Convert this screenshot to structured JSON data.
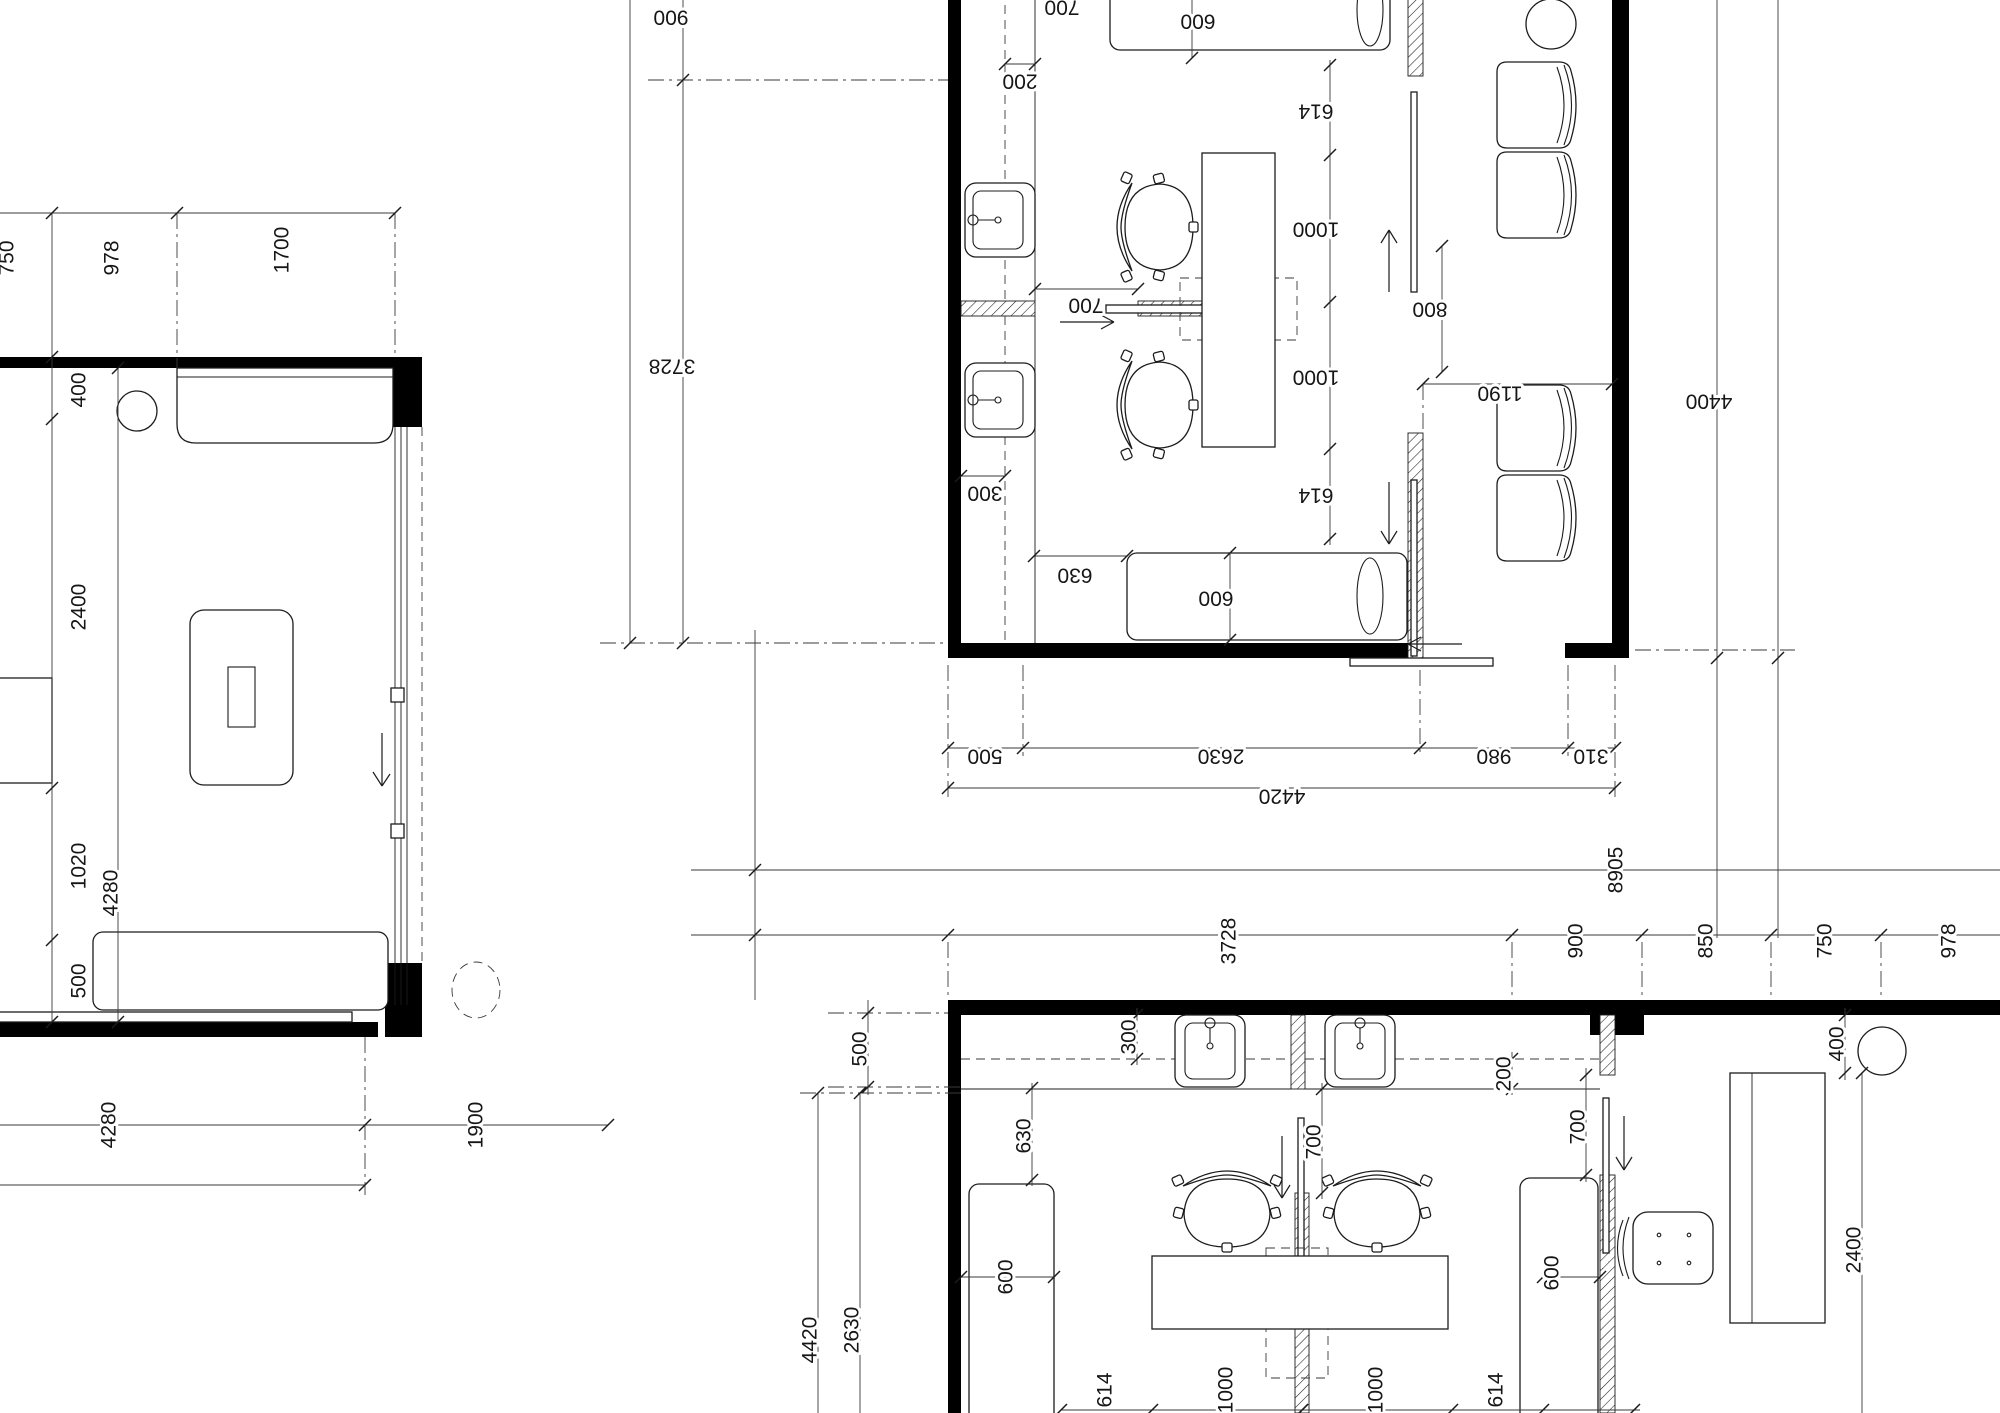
{
  "drawing": {
    "kind": "architectural floor plan, three plan views",
    "background": "#ffffff",
    "line_color": "#1c1c1c",
    "wall_color": "#000000"
  },
  "plans": {
    "a": {
      "name": "left room plan",
      "labels": [
        {
          "t": "750",
          "x": 8,
          "y": 258,
          "r": -90
        },
        {
          "t": "978",
          "x": 113,
          "y": 258,
          "r": -90
        },
        {
          "t": "1700",
          "x": 283,
          "y": 250,
          "r": -90
        },
        {
          "t": "400",
          "x": 80,
          "y": 390,
          "r": -90
        },
        {
          "t": "2400",
          "x": 80,
          "y": 607,
          "r": -90
        },
        {
          "t": "1020",
          "x": 80,
          "y": 866,
          "r": -90
        },
        {
          "t": "500",
          "x": 80,
          "y": 981,
          "r": -90
        },
        {
          "t": "4280",
          "x": 112,
          "y": 893,
          "r": -90
        },
        {
          "t": "4280",
          "x": 110,
          "y": 1125,
          "r": -90
        },
        {
          "t": "1900",
          "x": 477,
          "y": 1125,
          "r": -90
        }
      ]
    },
    "b": {
      "name": "upper right salon unit (rotated 180)",
      "labels": [
        {
          "t": "700",
          "x": 1062,
          "y": 6,
          "r": 180
        },
        {
          "t": "600",
          "x": 1198,
          "y": 20,
          "r": 180
        },
        {
          "t": "200",
          "x": 1020,
          "y": 80,
          "r": 180
        },
        {
          "t": "900",
          "x": 671,
          "y": 16,
          "r": 180
        },
        {
          "t": "3728",
          "x": 672,
          "y": 365,
          "r": 180
        },
        {
          "t": "614",
          "x": 1316,
          "y": 110,
          "r": 180
        },
        {
          "t": "1000",
          "x": 1316,
          "y": 228,
          "r": 180
        },
        {
          "t": "1000",
          "x": 1316,
          "y": 376,
          "r": 180
        },
        {
          "t": "614",
          "x": 1316,
          "y": 494,
          "r": 180
        },
        {
          "t": "700",
          "x": 1086,
          "y": 304,
          "r": 180
        },
        {
          "t": "300",
          "x": 985,
          "y": 492,
          "r": 180
        },
        {
          "t": "630",
          "x": 1075,
          "y": 574,
          "r": 180
        },
        {
          "t": "600",
          "x": 1216,
          "y": 597,
          "r": 180
        },
        {
          "t": "800",
          "x": 1430,
          "y": 308,
          "r": 180
        },
        {
          "t": "1190",
          "x": 1500,
          "y": 392,
          "r": 180
        },
        {
          "t": "4400",
          "x": 1709,
          "y": 400,
          "r": 180
        },
        {
          "t": "500",
          "x": 985,
          "y": 755,
          "r": 180
        },
        {
          "t": "2630",
          "x": 1221,
          "y": 755,
          "r": 180
        },
        {
          "t": "980",
          "x": 1494,
          "y": 755,
          "r": 180
        },
        {
          "t": "310",
          "x": 1591,
          "y": 755,
          "r": 180
        },
        {
          "t": "4420",
          "x": 1282,
          "y": 795,
          "r": 180
        }
      ]
    },
    "c": {
      "name": "lower right salon unit with adjacent room",
      "labels": [
        {
          "t": "8905",
          "x": 1617,
          "y": 870,
          "r": -90
        },
        {
          "t": "3728",
          "x": 1230,
          "y": 941,
          "r": -90
        },
        {
          "t": "900",
          "x": 1577,
          "y": 941,
          "r": -90
        },
        {
          "t": "850",
          "x": 1707,
          "y": 941,
          "r": -90
        },
        {
          "t": "750",
          "x": 1826,
          "y": 941,
          "r": -90
        },
        {
          "t": "978",
          "x": 1950,
          "y": 941,
          "r": -90
        },
        {
          "t": "4420",
          "x": 811,
          "y": 1340,
          "r": -90
        },
        {
          "t": "2630",
          "x": 853,
          "y": 1330,
          "r": -90
        },
        {
          "t": "500",
          "x": 861,
          "y": 1049,
          "r": -90
        },
        {
          "t": "300",
          "x": 1130,
          "y": 1037,
          "r": -90
        },
        {
          "t": "630",
          "x": 1025,
          "y": 1136,
          "r": -90
        },
        {
          "t": "600",
          "x": 1007,
          "y": 1277,
          "r": -90
        },
        {
          "t": "700",
          "x": 1315,
          "y": 1142,
          "r": -90
        },
        {
          "t": "200",
          "x": 1505,
          "y": 1074,
          "r": -90
        },
        {
          "t": "400",
          "x": 1838,
          "y": 1044,
          "r": -90
        },
        {
          "t": "2400",
          "x": 1855,
          "y": 1250,
          "r": -90
        },
        {
          "t": "600",
          "x": 1553,
          "y": 1273,
          "r": -90
        },
        {
          "t": "700",
          "x": 1579,
          "y": 1127,
          "r": -90
        },
        {
          "t": "614",
          "x": 1106,
          "y": 1390,
          "r": -90
        },
        {
          "t": "1000",
          "x": 1227,
          "y": 1390,
          "r": -90
        },
        {
          "t": "1000",
          "x": 1377,
          "y": 1390,
          "r": -90
        },
        {
          "t": "614",
          "x": 1497,
          "y": 1390,
          "r": -90
        }
      ]
    }
  }
}
